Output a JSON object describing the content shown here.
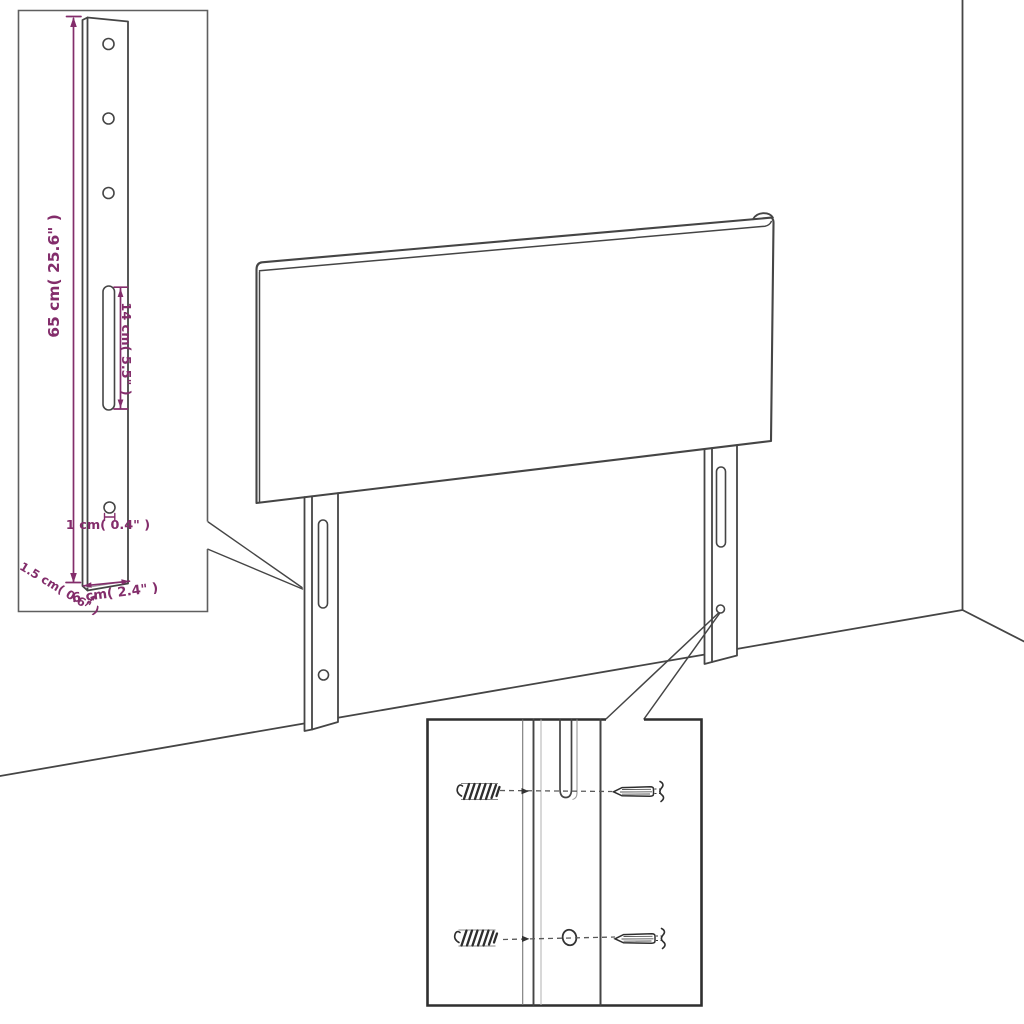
{
  "diagram": {
    "title": "headboard-wall-mount-assembly-diagram",
    "dimensions": {
      "bracket_height": "65 cm( 25.6\" )",
      "slot_length": "14 cm( 5.5\" )",
      "hole_diameter": "1 cm( 0.4\" )",
      "bracket_thickness": "1.5 cm( 0.6\" )",
      "bracket_width": "6 cm( 2.4\" )"
    },
    "colors": {
      "line": "#454545",
      "dimension": "#832d6b",
      "background": "#ffffff"
    }
  }
}
